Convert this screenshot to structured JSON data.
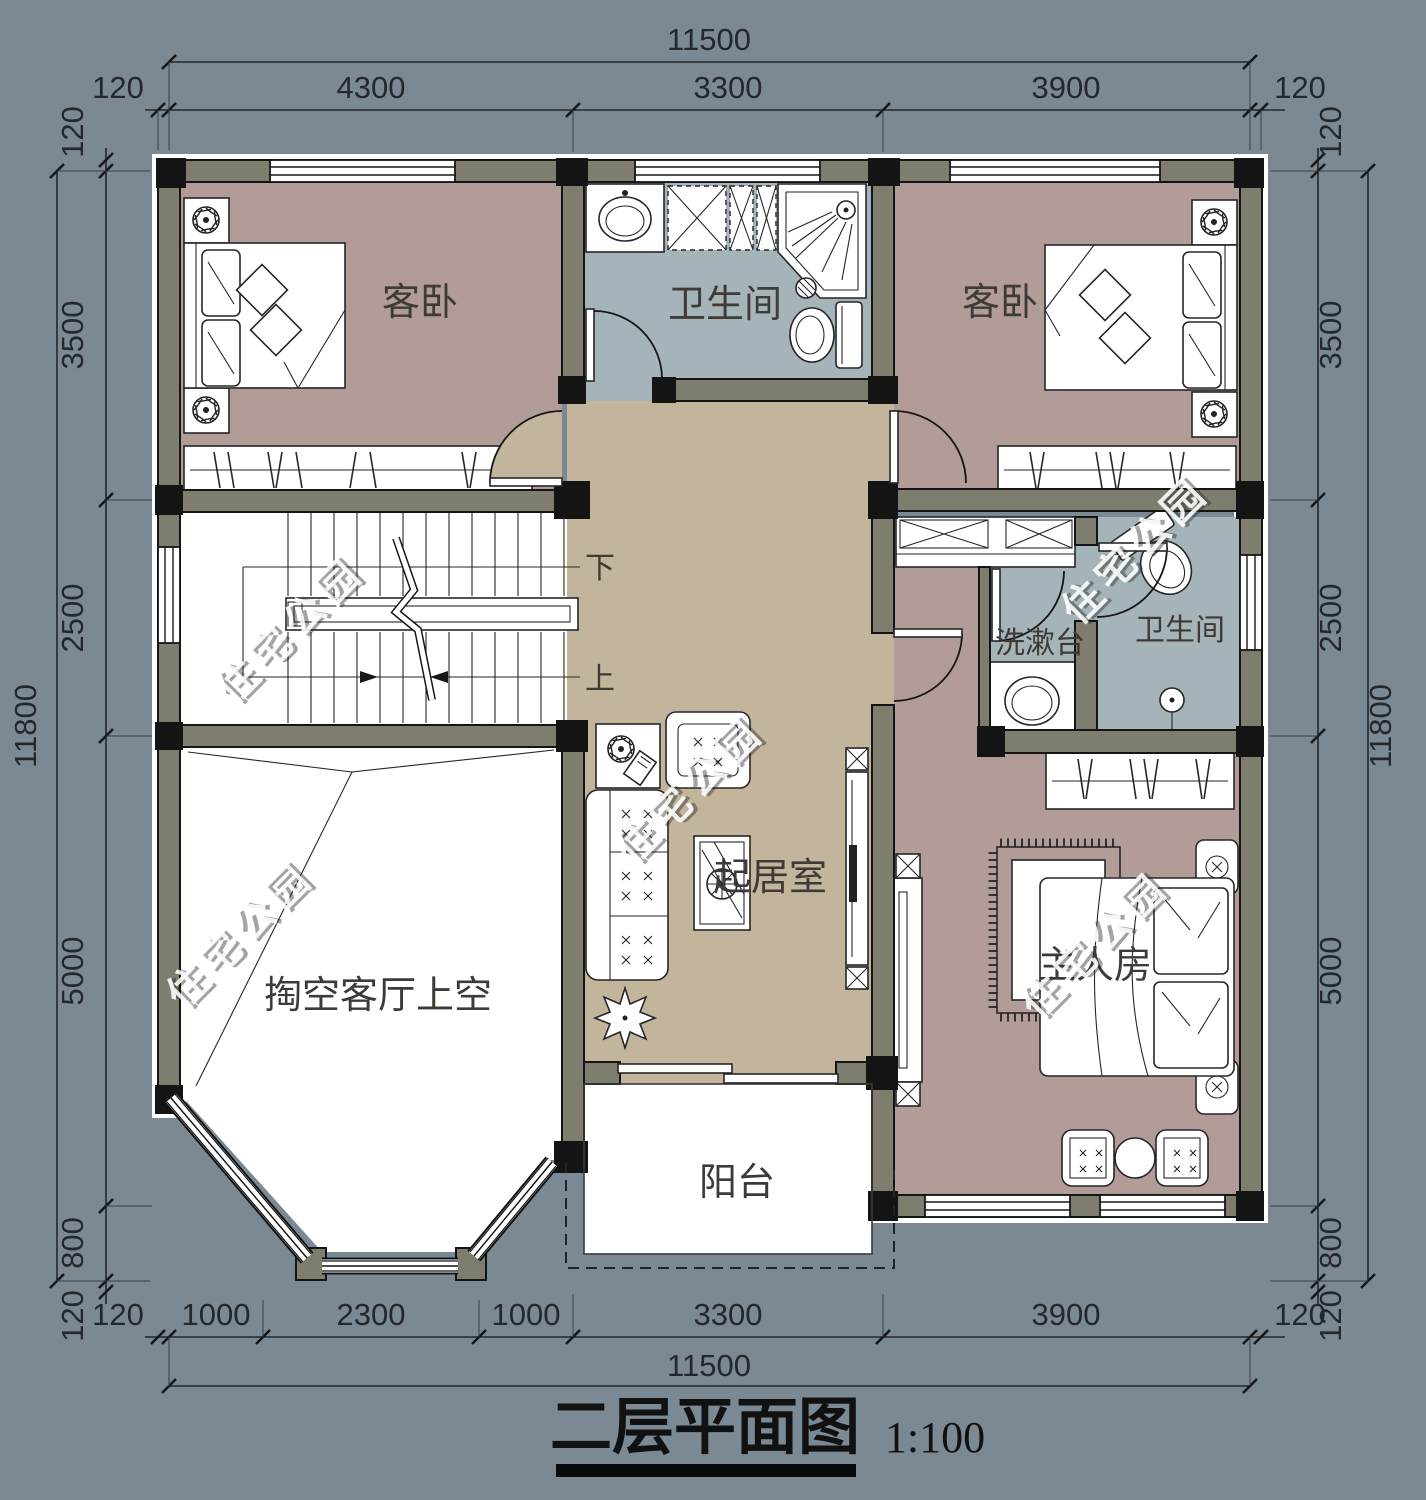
{
  "title": {
    "text": "二层平面图",
    "scale": "1:100"
  },
  "watermark": {
    "text": "住宅公园"
  },
  "rooms": {
    "guest_bedroom_left": "客卧",
    "guest_bedroom_right": "客卧",
    "bathroom_top": "卫生间",
    "bathroom_master": "卫生间",
    "washstand": "洗漱台",
    "living_room": "起居室",
    "void_above_living": "掏空客厅上空",
    "master_bedroom": "主人房",
    "balcony": "阳台",
    "stairs_down": "下",
    "stairs_up": "上"
  },
  "dimensions": {
    "top": {
      "overall": "11500",
      "segments": [
        "120",
        "4300",
        "3300",
        "3900",
        "120"
      ]
    },
    "bottom": {
      "overall": "11500",
      "segments": [
        "120",
        "1000",
        "2300",
        "1000",
        "3300",
        "3900",
        "120"
      ]
    },
    "left": {
      "overall": "11800",
      "segments": [
        "120",
        "3500",
        "2500",
        "5000",
        "800",
        "120"
      ]
    },
    "right": {
      "overall": "11800",
      "segments": [
        "120",
        "3500",
        "2500",
        "5000",
        "800",
        "120"
      ]
    }
  },
  "colors": {
    "background": "#7B8995",
    "floor_hall": "#C3B49C",
    "floor_bedroom": "#B29C98",
    "floor_bath": "#A4B4B8",
    "wall_fill": "#7F7E6E",
    "wall_line": "#141414",
    "dim_text": "#24282C",
    "label_text": "#3E3A36",
    "paper_white": "#FFFFFF"
  }
}
